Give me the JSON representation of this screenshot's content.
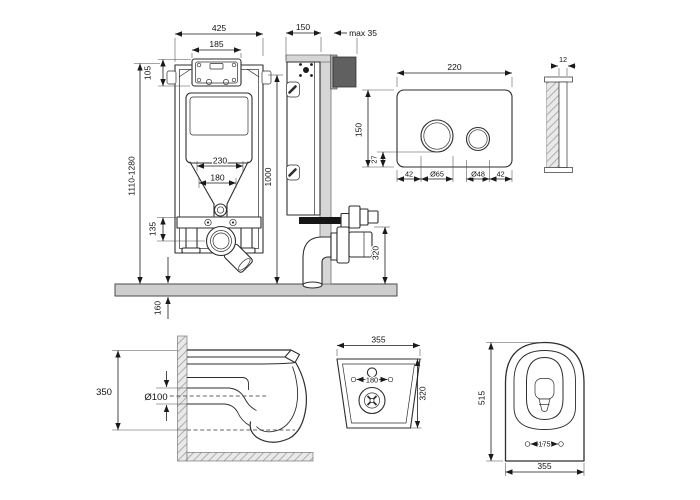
{
  "colors": {
    "floor": "#cdcdcd",
    "wall": "#d6d6d6",
    "bracket_dark": "#606060",
    "bracket_mid": "#a8a8a8",
    "pipe_dark": "#161616",
    "line": "#2e2e2e"
  },
  "frame_front": {
    "overall_width": "425",
    "access_box_width": "185",
    "access_box_height": "105",
    "height_range": "1110-1280",
    "outlet_width_outer": "230",
    "outlet_width_inner": "180",
    "outlet_height": "135",
    "below_floor_depth": "160"
  },
  "frame_side": {
    "depth": "150",
    "wall_allowance": "max 35",
    "height": "1000",
    "outlet_center_height": "320"
  },
  "flush_plate_front": {
    "width": "220",
    "height": "150",
    "button_bottom_offset": "27",
    "left_margin": "42",
    "large_button_diameter": "Ø65",
    "small_button_diameter": "Ø48",
    "right_margin": "42"
  },
  "flush_plate_side": {
    "thickness": "12"
  },
  "bowl_side": {
    "height": "350",
    "outlet_diameter": "Ø100"
  },
  "bowl_back": {
    "width": "355",
    "bolt_spacing": "180",
    "height": "320"
  },
  "bowl_top": {
    "length": "515",
    "seat_bolt_spacing": "175",
    "width": "355"
  }
}
